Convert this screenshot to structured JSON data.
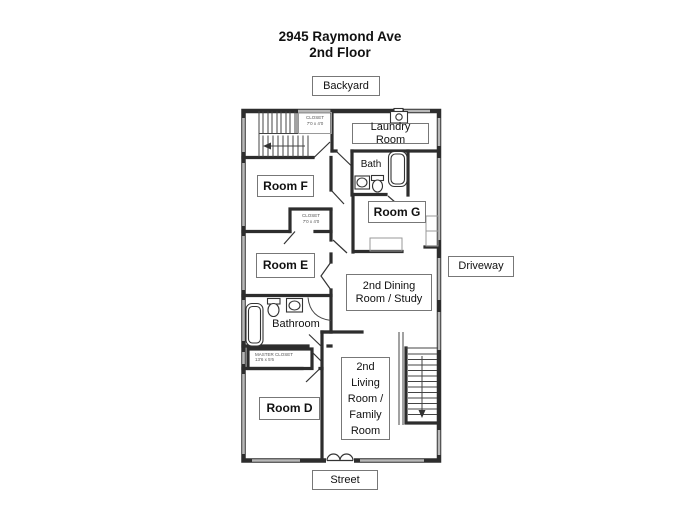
{
  "title": {
    "line1": "2945 Raymond Ave",
    "line2": "2nd Floor"
  },
  "exterior": {
    "backyard": "Backyard",
    "driveway": "Driveway",
    "street": "Street"
  },
  "rooms": {
    "laundry_room": "Laundry Room",
    "bath": "Bath",
    "room_f": "Room F",
    "room_g": "Room G",
    "room_e": "Room E",
    "dining_study": "2nd Dining Room / Study",
    "bathroom": "Bathroom",
    "room_d": "Room D",
    "living_family": "2nd Living Room / Family Room"
  },
  "closets": {
    "stair_closet_line1": "CLOSET",
    "stair_closet_line2": "7'0 x 4'0",
    "hall_closet_line1": "CLOSET",
    "hall_closet_line2": "7'0 x 4'0",
    "master_closet_line1": "MASTER CLOSET",
    "master_closet_line2": "13'6 x 5'6"
  },
  "colors": {
    "wall": "#2d2d2d",
    "window": "#b8b8b8",
    "label_border": "#777777",
    "background": "#ffffff"
  }
}
